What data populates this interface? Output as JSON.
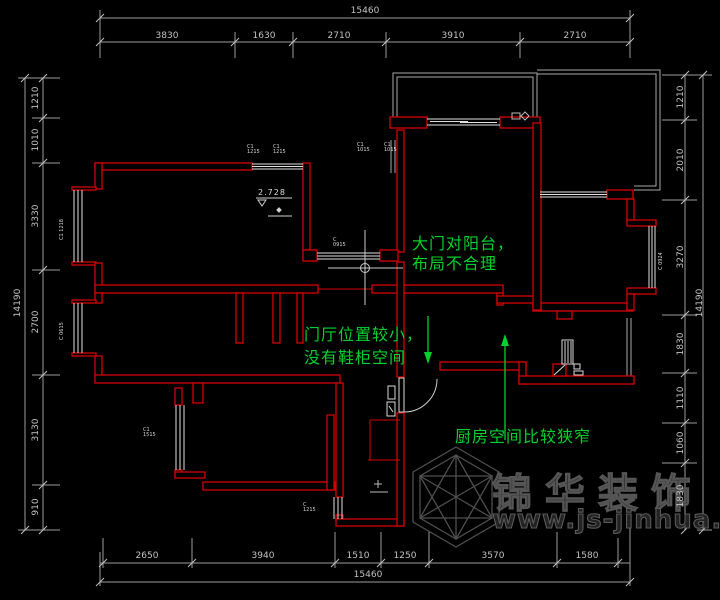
{
  "colors": {
    "wall_red": "#d40000",
    "dim_gray": "#a9a9a9",
    "note_green": "#00d22c",
    "window_white": "#e0e0e0",
    "watermark_gray": "#4f4f4f",
    "background": "#000000"
  },
  "dimensions": {
    "top_total": "15460",
    "top_segments": [
      "3830",
      "1630",
      "2710",
      "3910",
      "2710"
    ],
    "bottom_segments": [
      "2650",
      "3940",
      "1510",
      "1250",
      "3570",
      "1580"
    ],
    "bottom_total": "15460",
    "left_total": "14190",
    "left_segments": [
      "1210",
      "1010",
      "3330",
      "2700",
      "3130",
      "910"
    ],
    "right_total": "14190",
    "right_segments": [
      "1210",
      "2010",
      "3270",
      "1830",
      "1110",
      "1060",
      "1830"
    ]
  },
  "annotations": {
    "balcony_note": [
      "大门对阳台，",
      "布局不合理"
    ],
    "foyer_note": [
      "门厅位置较小，",
      "没有鞋柜空间"
    ],
    "kitchen_note": "厨房空间比较狭窄"
  },
  "level_mark": "2.728",
  "window_tags": [
    "C1 1215",
    "C1 1215",
    "C1 1015",
    "C1 1015",
    "C 0915",
    "C1 1515",
    "C1 1218",
    "C 0615",
    "C 1215",
    "C 0924"
  ],
  "watermark": {
    "brand": "锦华装饰",
    "url": "www.js-jinhua.com"
  }
}
